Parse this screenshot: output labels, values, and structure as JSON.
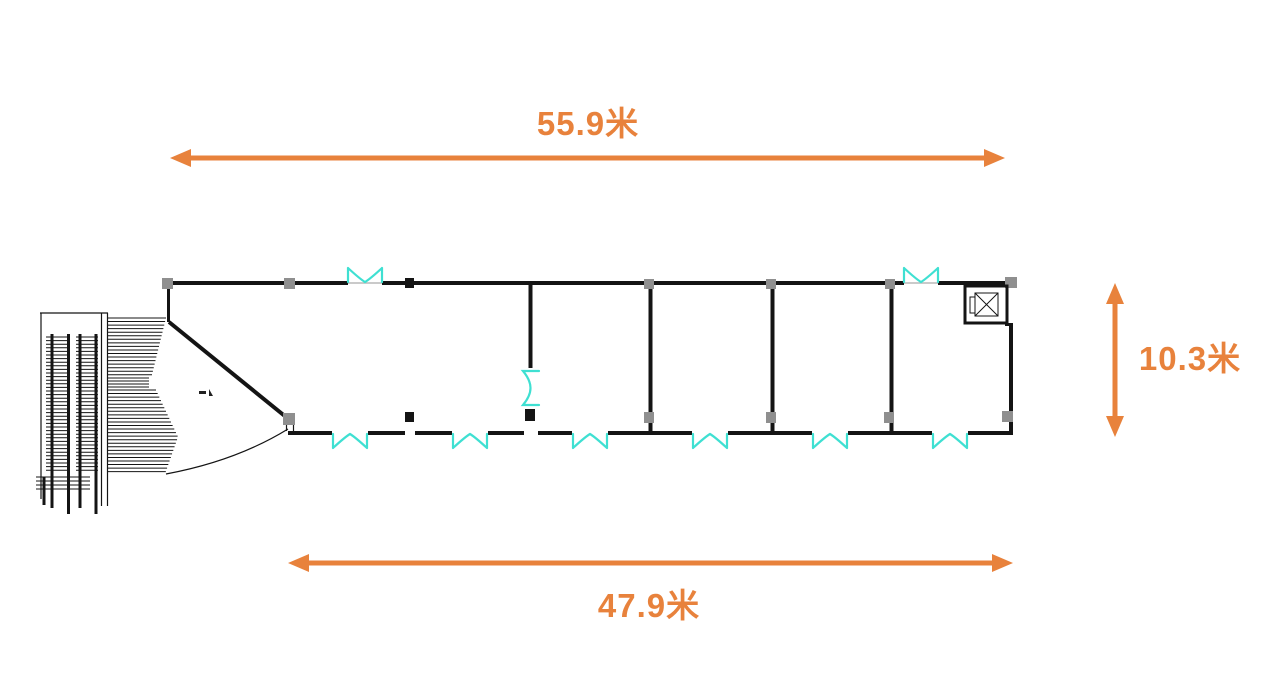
{
  "colors": {
    "dimension_accent": "#E8823C",
    "wall": "#141414",
    "door": "#3FE0D2",
    "column_marker": "#8f8f8f"
  },
  "dimensions": {
    "top_width": {
      "label": "55.9米",
      "value_meters": 55.9
    },
    "bottom_width": {
      "label": "47.9米",
      "value_meters": 47.9
    },
    "right_height": {
      "label": "10.3米",
      "value_meters": 10.3
    }
  },
  "icons": {
    "doors": "double-swing-door-icon",
    "elevator": "elevator-icon",
    "stairs": "escalator-stairs-icon"
  },
  "plan": {
    "top_door_count": 2,
    "bottom_door_count": 6,
    "partition_count": 4
  }
}
